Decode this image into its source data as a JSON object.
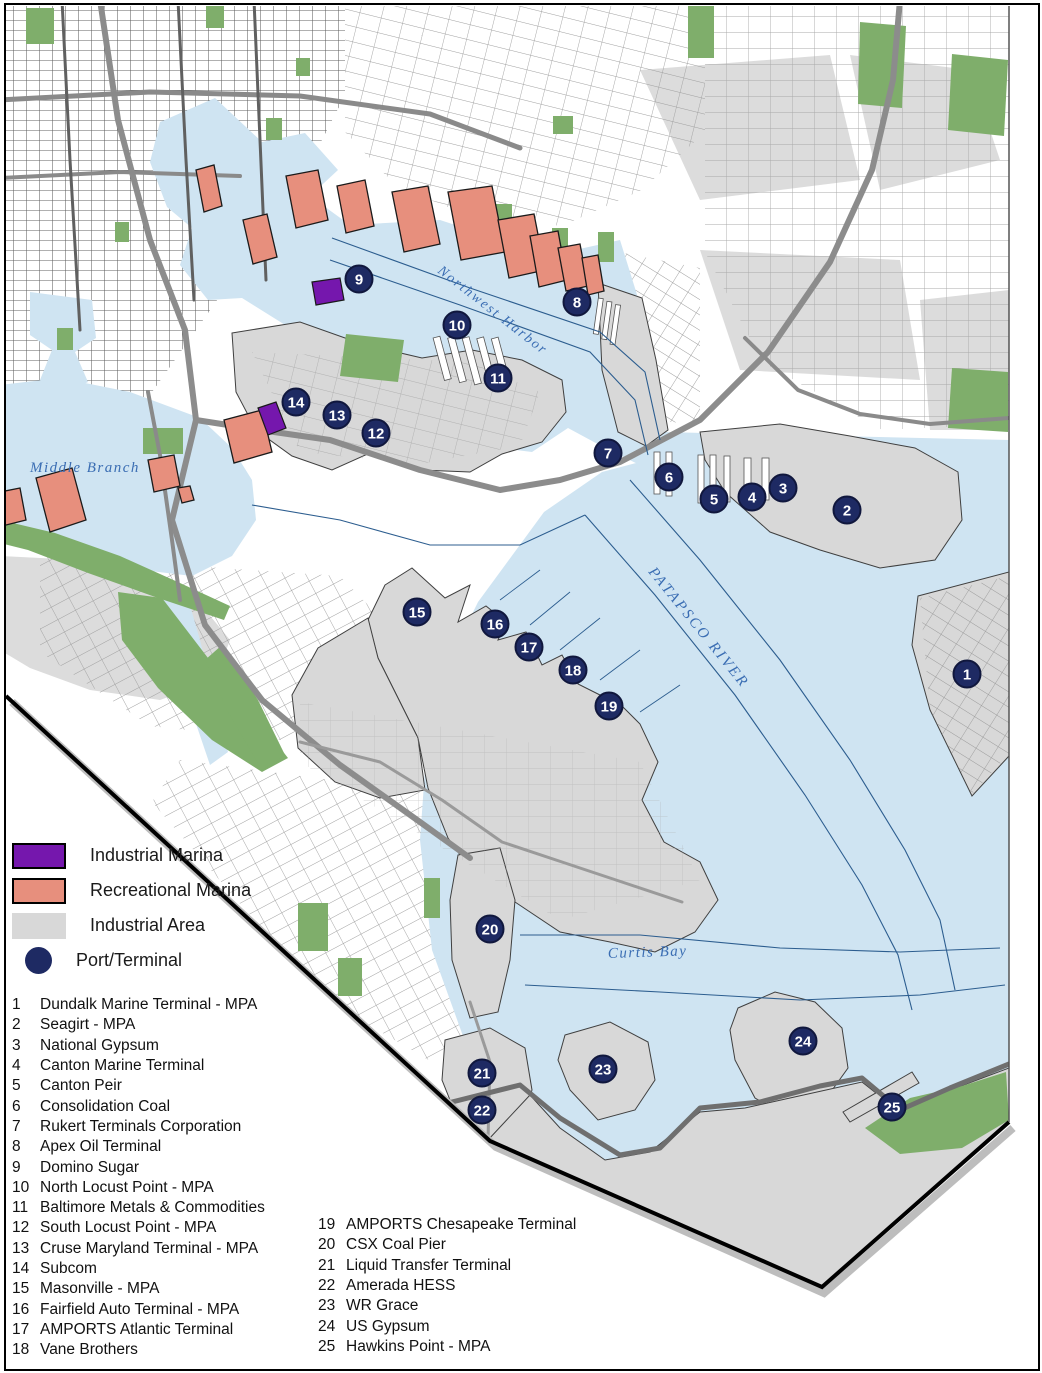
{
  "legend": {
    "items": [
      {
        "label": "Industrial Marina",
        "shape": "rect",
        "color": "#7517ad",
        "border": true
      },
      {
        "label": "Recreational Marina",
        "shape": "rect",
        "color": "#e78f7d",
        "border": true
      },
      {
        "label": "Industrial Area",
        "shape": "rect",
        "color": "#d8d8d8",
        "border": false
      },
      {
        "label": "Port/Terminal",
        "shape": "circle",
        "color": "#1e2a63",
        "border": false
      }
    ]
  },
  "terminals": {
    "column1": [
      {
        "num": "1",
        "name": "Dundalk Marine Terminal - MPA"
      },
      {
        "num": "2",
        "name": "Seagirt - MPA"
      },
      {
        "num": "3",
        "name": "National Gypsum"
      },
      {
        "num": "4",
        "name": "Canton Marine Terminal"
      },
      {
        "num": "5",
        "name": "Canton Peir"
      },
      {
        "num": "6",
        "name": "Consolidation Coal"
      },
      {
        "num": "7",
        "name": "Rukert Terminals Corporation"
      },
      {
        "num": "8",
        "name": "Apex Oil Terminal"
      },
      {
        "num": "9",
        "name": "Domino Sugar"
      },
      {
        "num": "10",
        "name": "North Locust Point - MPA"
      },
      {
        "num": "11",
        "name": "Baltimore Metals & Commodities"
      },
      {
        "num": "12",
        "name": "South Locust Point - MPA"
      },
      {
        "num": "13",
        "name": "Cruse Maryland Terminal - MPA"
      },
      {
        "num": "14",
        "name": "Subcom"
      },
      {
        "num": "15",
        "name": "Masonville - MPA"
      },
      {
        "num": "16",
        "name": "Fairfield Auto Terminal - MPA"
      },
      {
        "num": "17",
        "name": "AMPORTS Atlantic Terminal"
      },
      {
        "num": "18",
        "name": "Vane Brothers"
      }
    ],
    "column2": [
      {
        "num": "19",
        "name": "AMPORTS Chesapeake Terminal"
      },
      {
        "num": "20",
        "name": "CSX Coal Pier"
      },
      {
        "num": "21",
        "name": "Liquid Transfer Terminal"
      },
      {
        "num": "22",
        "name": "Amerada HESS"
      },
      {
        "num": "23",
        "name": "WR Grace"
      },
      {
        "num": "24",
        "name": "US Gypsum"
      },
      {
        "num": "25",
        "name": "Hawkins Point - MPA"
      }
    ]
  },
  "water_labels": [
    {
      "text": "Middle Branch",
      "x": 30,
      "y": 472,
      "angle": 0,
      "italic": true,
      "size": 15,
      "spacing": 1.5
    },
    {
      "text": "Northwest Harbor",
      "x": 437,
      "y": 272,
      "angle": 38,
      "italic": true,
      "size": 14,
      "spacing": 2
    },
    {
      "text": "PATAPSCO RIVER",
      "x": 648,
      "y": 572,
      "angle": 51,
      "italic": true,
      "size": 15,
      "spacing": 2.5
    },
    {
      "text": "Curtis Bay",
      "x": 608,
      "y": 958,
      "angle": -2,
      "italic": true,
      "size": 15,
      "spacing": 1.5
    }
  ],
  "markers": [
    {
      "num": "1",
      "x": 967,
      "y": 674
    },
    {
      "num": "2",
      "x": 847,
      "y": 510
    },
    {
      "num": "3",
      "x": 783,
      "y": 488
    },
    {
      "num": "4",
      "x": 752,
      "y": 497
    },
    {
      "num": "5",
      "x": 714,
      "y": 499
    },
    {
      "num": "6",
      "x": 669,
      "y": 477
    },
    {
      "num": "7",
      "x": 608,
      "y": 453
    },
    {
      "num": "8",
      "x": 577,
      "y": 302
    },
    {
      "num": "9",
      "x": 359,
      "y": 279
    },
    {
      "num": "10",
      "x": 457,
      "y": 325
    },
    {
      "num": "11",
      "x": 498,
      "y": 378
    },
    {
      "num": "12",
      "x": 376,
      "y": 433
    },
    {
      "num": "13",
      "x": 337,
      "y": 415
    },
    {
      "num": "14",
      "x": 296,
      "y": 402
    },
    {
      "num": "15",
      "x": 417,
      "y": 612
    },
    {
      "num": "16",
      "x": 495,
      "y": 624
    },
    {
      "num": "17",
      "x": 529,
      "y": 647
    },
    {
      "num": "18",
      "x": 573,
      "y": 670
    },
    {
      "num": "19",
      "x": 609,
      "y": 706
    },
    {
      "num": "20",
      "x": 490,
      "y": 929
    },
    {
      "num": "21",
      "x": 482,
      "y": 1073
    },
    {
      "num": "22",
      "x": 482,
      "y": 1110
    },
    {
      "num": "23",
      "x": 603,
      "y": 1069
    },
    {
      "num": "24",
      "x": 803,
      "y": 1041
    },
    {
      "num": "25",
      "x": 892,
      "y": 1107
    }
  ],
  "colors": {
    "water": "#cfe4f2",
    "industrial_area": "#d8d8d8",
    "industrial_marina": "#7517ad",
    "recreational_marina": "#e78f7d",
    "park": "#7fae6b",
    "port_marker": "#1e2a63",
    "port_marker_ring": "#10173d",
    "water_label": "#3a6db3",
    "coastline": "#3f3f3f"
  }
}
